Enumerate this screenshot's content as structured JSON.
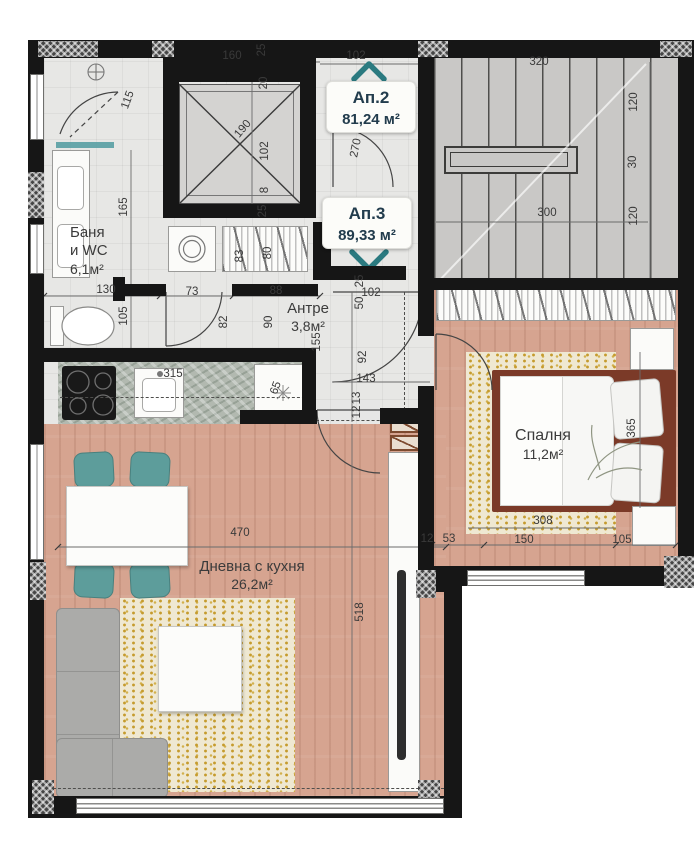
{
  "apartment_labels": [
    {
      "name": "Ап.2",
      "area": "81,24 м²"
    },
    {
      "name": "Ап.3",
      "area": "89,33 м²"
    }
  ],
  "rooms": {
    "bathroom": {
      "line1": "Баня",
      "line2": "и WC",
      "area": "6,1м²"
    },
    "entry": {
      "name": "Антре",
      "area": "3,8м²"
    },
    "bedroom": {
      "name": "Спалня",
      "area": "11,2м²"
    },
    "living": {
      "name": "Дневна с кухня",
      "area": "26,2м²"
    }
  },
  "icons": {
    "up_chevron_icon": "chevron pointing up (apartment 2 entrance)",
    "down_chevron_icon": "chevron pointing down (apartment 3 entrance)",
    "washing_machine_icon": "double circle drum",
    "shower_head_icon": "circle with cross",
    "snowflake_icon": "asterisk on fridge",
    "elevator_icon": "crossed box shaft",
    "stairs_icon": "stepped flight with rail"
  },
  "colors": {
    "wall": "#161616",
    "floor_tile": "#e7e7e5",
    "stair_grey": "#c9c8c6",
    "wood_floor": "#d6a490",
    "rug_gold": "#c59b2e",
    "chair_teal": "#5d9d9b",
    "label_navy": "#223c4d",
    "chevron_teal": "#2b7a80",
    "bed_frame_brown": "#7b3a28"
  },
  "dimensions": [
    {
      "label": "160",
      "x": 232,
      "y": 56,
      "r": 0
    },
    {
      "label": "25",
      "x": 262,
      "y": 50,
      "r": -90
    },
    {
      "label": "102",
      "x": 356,
      "y": 56,
      "r": 0
    },
    {
      "label": "20",
      "x": 264,
      "y": 83,
      "r": -90
    },
    {
      "label": "190",
      "x": 243,
      "y": 129,
      "r": -50
    },
    {
      "label": "102",
      "x": 265,
      "y": 151,
      "r": -90
    },
    {
      "label": "8",
      "x": 265,
      "y": 190,
      "r": -90
    },
    {
      "label": "25",
      "x": 263,
      "y": 211,
      "r": -90
    },
    {
      "label": "270",
      "x": 356,
      "y": 148,
      "r": -78
    },
    {
      "label": "320",
      "x": 539,
      "y": 62,
      "r": 0
    },
    {
      "label": "120",
      "x": 634,
      "y": 102,
      "r": -90
    },
    {
      "label": "30",
      "x": 633,
      "y": 162,
      "r": -90
    },
    {
      "label": "120",
      "x": 634,
      "y": 216,
      "r": -90
    },
    {
      "label": "300",
      "x": 547,
      "y": 213,
      "r": 0
    },
    {
      "label": "115",
      "x": 128,
      "y": 100,
      "r": -70
    },
    {
      "label": "165",
      "x": 124,
      "y": 207,
      "r": -90
    },
    {
      "label": "130",
      "x": 106,
      "y": 290,
      "r": 0
    },
    {
      "label": "105",
      "x": 124,
      "y": 316,
      "r": -90
    },
    {
      "label": "73",
      "x": 192,
      "y": 292,
      "r": 0
    },
    {
      "label": "88",
      "x": 276,
      "y": 291,
      "r": 0
    },
    {
      "label": "83",
      "x": 240,
      "y": 256,
      "r": -90
    },
    {
      "label": "80",
      "x": 268,
      "y": 253,
      "r": -90
    },
    {
      "label": "82",
      "x": 224,
      "y": 322,
      "r": -90
    },
    {
      "label": "90",
      "x": 269,
      "y": 322,
      "r": -90
    },
    {
      "label": "102",
      "x": 371,
      "y": 293,
      "r": 0
    },
    {
      "label": "25",
      "x": 360,
      "y": 281,
      "r": -90
    },
    {
      "label": "50",
      "x": 360,
      "y": 303,
      "r": -90
    },
    {
      "label": "155",
      "x": 317,
      "y": 342,
      "r": -90
    },
    {
      "label": "92",
      "x": 363,
      "y": 357,
      "r": -90
    },
    {
      "label": "143",
      "x": 366,
      "y": 379,
      "r": 0
    },
    {
      "label": "13",
      "x": 357,
      "y": 398,
      "r": -90
    },
    {
      "label": "12",
      "x": 357,
      "y": 412,
      "r": -90
    },
    {
      "label": "315",
      "x": 173,
      "y": 374,
      "r": 0
    },
    {
      "label": "65",
      "x": 276,
      "y": 388,
      "r": -70
    },
    {
      "label": "470",
      "x": 240,
      "y": 533,
      "r": 0
    },
    {
      "label": "518",
      "x": 360,
      "y": 612,
      "r": -90
    },
    {
      "label": "365",
      "x": 632,
      "y": 428,
      "r": -90
    },
    {
      "label": "308",
      "x": 543,
      "y": 521,
      "r": 0
    },
    {
      "label": "12",
      "x": 427,
      "y": 539,
      "r": 0
    },
    {
      "label": "53",
      "x": 449,
      "y": 539,
      "r": 0
    },
    {
      "label": "150",
      "x": 524,
      "y": 540,
      "r": 0
    },
    {
      "label": "105",
      "x": 622,
      "y": 540,
      "r": 0
    }
  ]
}
